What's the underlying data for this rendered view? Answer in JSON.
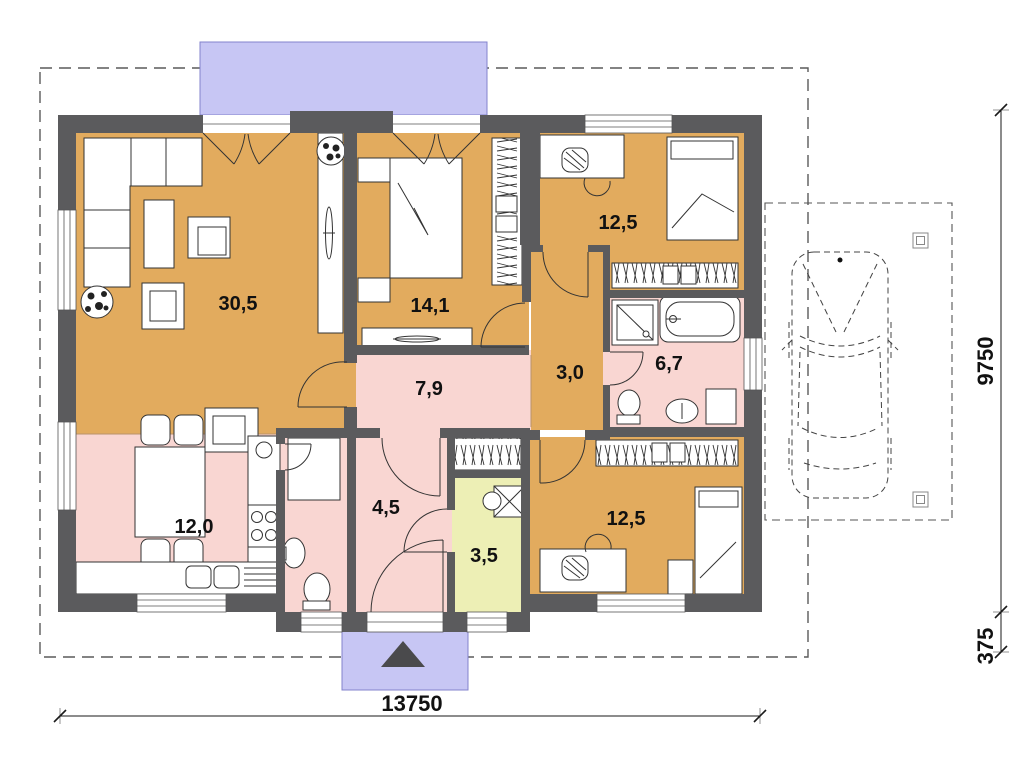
{
  "plan": {
    "rooms": [
      {
        "id": "living-room",
        "area": "30,5"
      },
      {
        "id": "bedroom-left",
        "area": "14,1"
      },
      {
        "id": "bedroom-top-right",
        "area": "12,5"
      },
      {
        "id": "corridor",
        "area": "3,0"
      },
      {
        "id": "bathroom",
        "area": "6,7"
      },
      {
        "id": "hallway",
        "area": "7,9"
      },
      {
        "id": "kitchen-dining",
        "area": "12,0"
      },
      {
        "id": "entrance-hall",
        "area": "4,5"
      },
      {
        "id": "pantry",
        "area": "3,5"
      },
      {
        "id": "bedroom-bottom-right",
        "area": "12,5"
      }
    ],
    "dimensions": {
      "total_width": "13750",
      "total_height": "9750",
      "porch_offset": "375"
    }
  },
  "colors": {
    "floor_orange": "#e2ab5e",
    "floor_pink": "#f9d6d2",
    "floor_yellow": "#edefb5",
    "porch_blue": "#c7c6f4",
    "porch_border": "#8383cc",
    "wall": "#5b5b5d"
  }
}
